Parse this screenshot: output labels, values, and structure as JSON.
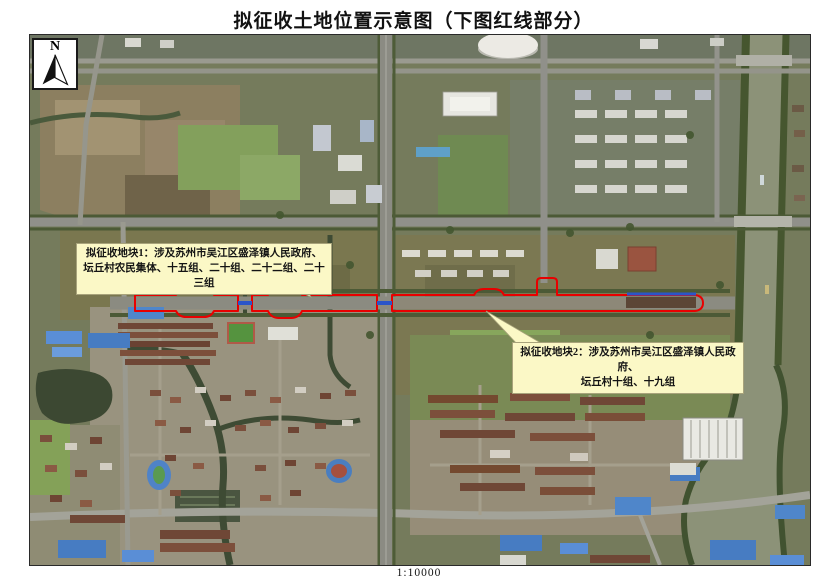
{
  "title": "拟征收土地位置示意图（下图红线部分）",
  "map": {
    "north_label": "N",
    "scale_label": "1:10000",
    "callouts": [
      {
        "line1": "拟征收地块1：涉及苏州市吴江区盛泽镇人民政府、",
        "line2": "坛丘村农民集体、十五组、二十组、二十二组、二十三组"
      },
      {
        "line1": "拟征收地块2：涉及苏州市吴江区盛泽镇人民政府、",
        "line2": "坛丘村十组、十九组"
      }
    ],
    "colors": {
      "red_line": "#e80000",
      "bridge_blue": "#2b55c8",
      "callout_bg": "#fbf8c6"
    }
  }
}
